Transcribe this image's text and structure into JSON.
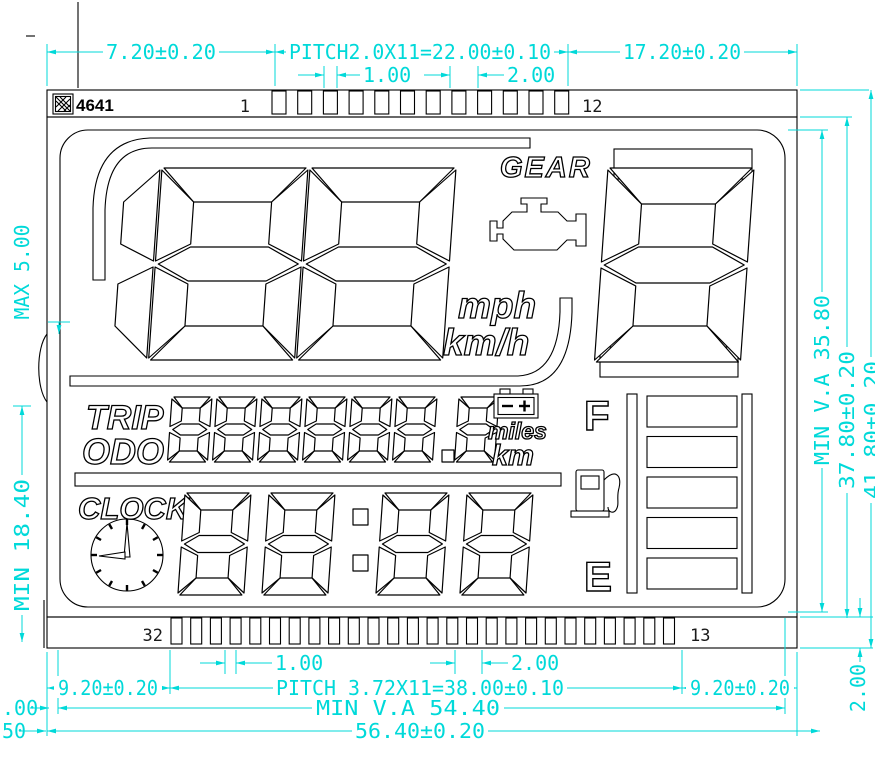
{
  "title_label": "4641",
  "accent_color": "#00d9d9",
  "pins": {
    "top_first": "1",
    "top_last": "12",
    "bottom_left": "32",
    "bottom_right": "13",
    "top_pad_count": 12,
    "bottom_pad_count": 26
  },
  "dimensions": {
    "top_left": "7.20±0.20",
    "top_pitch": "PITCH2.0X11=22.00±0.10",
    "top_right": "17.20±0.20",
    "top_pad_width": "1.00",
    "top_pad_pitch": "2.00",
    "left_max": "MAX 5.00",
    "left_min": "MIN 18.40",
    "right_va": "MIN V.A 35.80",
    "right_glass": "37.80±0.20",
    "right_overall": "41.80±0.20",
    "right_pin_strip": "2.00",
    "bottom_pad_width": "1.00",
    "bottom_pad_pitch": "2.00",
    "bottom_left_margin": "9.20±0.20",
    "bottom_pitch": "PITCH 3.72X11=38.00±0.10",
    "bottom_right_margin": "9.20±0.20",
    "bottom_va": "MIN V.A 54.40",
    "bottom_overall": "56.40±0.20",
    "cut_fragment_1": ".00",
    "cut_fragment_2": "50"
  },
  "display": {
    "gear_label": "GEAR",
    "gear_value": "8",
    "speed_value": "188",
    "unit_mph": "mph",
    "unit_kmh": "km/h",
    "trip_label": "TRIP",
    "odo_label": "ODO",
    "odo_value": "888888.8",
    "unit_miles": "miles",
    "unit_km": "km",
    "clock_label": "CLOCK",
    "clock_value": "88:88",
    "fuel_full": "F",
    "fuel_empty": "E",
    "fuel_bars": 5,
    "icons": [
      "engine-warning-icon",
      "battery-icon",
      "fuel-pump-icon",
      "clock-icon",
      "hatch-icon"
    ]
  }
}
